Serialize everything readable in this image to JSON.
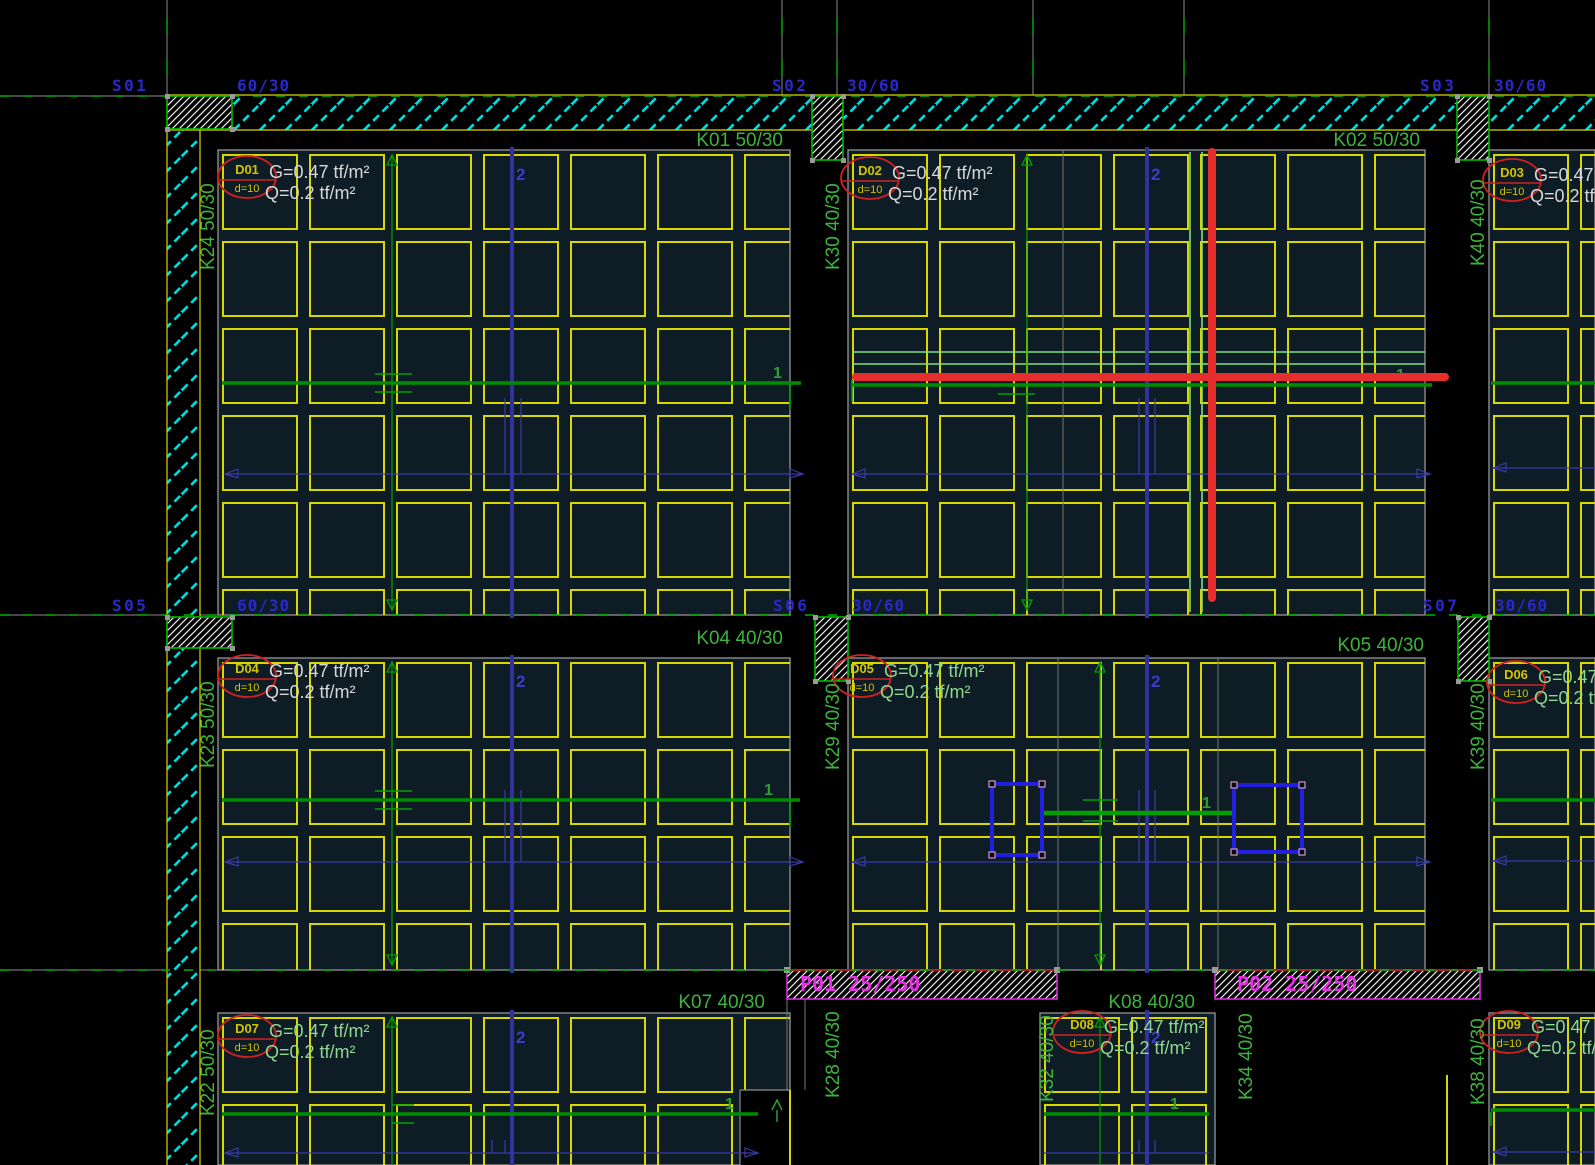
{
  "app": {
    "view_name": "slab-formwork-plan"
  },
  "colors": {
    "background": "#000000",
    "panel_fill": "#0e1c26",
    "rib": "#d8d800",
    "panel_border": "#8c8c8c",
    "wall_hatch": "#00dcdc",
    "column_hatch": "#ececec",
    "column_border": "#00bb00",
    "beam_label": "#3cb43c",
    "load_text_white": "#d8d8d8",
    "load_text_green": "#8fd88f",
    "column_label": "#2828cc",
    "strip_blue": "#32329c",
    "strip_blue_label": "#3c3cc8",
    "dim_blue": "#3a3aaa",
    "span_green": "#00a000",
    "strip_green": "#008c00",
    "strip_green_label": "#2da02d",
    "axis_green": "#00b400",
    "axis_gray": "#8a8a8a",
    "selection_red": "#e62e2e",
    "tag_red": "#d02020",
    "tag_yellow": "#d2c400",
    "magenta": "#e830e8",
    "rib_highlight": "#80e080",
    "grip": "#d098d0",
    "opening_blue": "#2020dd"
  },
  "axes": {
    "vertical_x": [
      167,
      782,
      837,
      1033,
      1184,
      1489
    ],
    "horizontal_y": [
      96,
      615,
      970
    ]
  },
  "walls": {
    "top": [
      167,
      95,
      1428,
      35
    ],
    "left": [
      167,
      130,
      33,
      1035
    ]
  },
  "shear_walls": [
    {
      "label": "P01 25/250",
      "rect": [
        787,
        970,
        270,
        29
      ],
      "label_pos": [
        800,
        991
      ]
    },
    {
      "label": "P02 25/250",
      "rect": [
        1215,
        970,
        265,
        29
      ],
      "label_pos": [
        1237,
        991
      ]
    }
  ],
  "columns": [
    {
      "name": "S01",
      "size": "60/30",
      "rect": [
        167,
        96,
        65,
        33
      ],
      "name_pos": [
        112,
        91
      ],
      "size_pos": [
        237,
        91
      ]
    },
    {
      "name": "S02",
      "size": "30/60",
      "rect": [
        812,
        96,
        31,
        64
      ],
      "name_pos": [
        772,
        91
      ],
      "size_pos": [
        847,
        91
      ]
    },
    {
      "name": "S03",
      "size": "30/60",
      "rect": [
        1457,
        96,
        32,
        64
      ],
      "name_pos": [
        1420,
        91
      ],
      "size_pos": [
        1494,
        91
      ]
    },
    {
      "name": "S05",
      "size": "60/30",
      "rect": [
        167,
        617,
        65,
        31
      ],
      "name_pos": [
        112,
        611
      ],
      "size_pos": [
        237,
        611
      ]
    },
    {
      "name": "S06",
      "size": "30/60",
      "rect": [
        815,
        617,
        33,
        64
      ],
      "name_pos": [
        773,
        611
      ],
      "size_pos": [
        852,
        611
      ]
    },
    {
      "name": "S07",
      "size": "30/60",
      "rect": [
        1458,
        617,
        31,
        64
      ],
      "name_pos": [
        1423,
        611
      ],
      "size_pos": [
        1495,
        611
      ]
    }
  ],
  "beams_horizontal": [
    {
      "label": "K01 50/30",
      "pos": [
        783,
        146
      ]
    },
    {
      "label": "K02 50/30",
      "pos": [
        1420,
        146
      ]
    },
    {
      "label": "K04 40/30",
      "pos": [
        783,
        644
      ]
    },
    {
      "label": "K05 40/30",
      "pos": [
        1424,
        651
      ]
    },
    {
      "label": "K07 40/30",
      "pos": [
        765,
        1008
      ]
    },
    {
      "label": "K08 40/30",
      "pos": [
        1195,
        1008
      ]
    }
  ],
  "beams_vertical": [
    {
      "label": "K24 50/30",
      "pos": [
        214,
        270
      ]
    },
    {
      "label": "K30 40/30",
      "pos": [
        839,
        270
      ]
    },
    {
      "label": "K40 40/30",
      "pos": [
        1484,
        266
      ]
    },
    {
      "label": "K23 50/30",
      "pos": [
        214,
        768
      ]
    },
    {
      "label": "K29 40/30",
      "pos": [
        839,
        770
      ]
    },
    {
      "label": "K39 40/30",
      "pos": [
        1484,
        770
      ]
    },
    {
      "label": "K22 50/30",
      "pos": [
        214,
        1116
      ]
    },
    {
      "label": "K28 40/30",
      "pos": [
        839,
        1098
      ]
    },
    {
      "label": "K32 40/30",
      "pos": [
        1053,
        1102
      ]
    },
    {
      "label": "K34 40/30",
      "pos": [
        1252,
        1100
      ]
    },
    {
      "label": "K38 40/30",
      "pos": [
        1484,
        1105
      ]
    }
  ],
  "panels": [
    {
      "id": "P1",
      "slab": "D01",
      "rect": [
        218,
        150,
        572,
        465
      ]
    },
    {
      "id": "P2",
      "slab": "D02",
      "rect": [
        848,
        150,
        577,
        465
      ]
    },
    {
      "id": "P3",
      "slab": "D03",
      "rect": [
        1489,
        150,
        106,
        465
      ]
    },
    {
      "id": "P4",
      "slab": "D04",
      "rect": [
        218,
        658,
        572,
        312
      ]
    },
    {
      "id": "P5",
      "slab": "D05",
      "rect": [
        848,
        658,
        577,
        312
      ]
    },
    {
      "id": "P6",
      "slab": "D06",
      "rect": [
        1489,
        658,
        106,
        312
      ]
    },
    {
      "id": "P7",
      "slab": "D07",
      "rect": [
        218,
        1013,
        572,
        152
      ]
    },
    {
      "id": "P8",
      "slab": "D08",
      "rect": [
        1040,
        1013,
        175,
        152
      ]
    },
    {
      "id": "P9",
      "slab": "D09",
      "rect": [
        1489,
        1013,
        106,
        152
      ]
    }
  ],
  "slab_tags": [
    {
      "id": "D01",
      "thickness": "d=10",
      "g": "G=0.47 tf/m²",
      "q": "Q=0.2 tf/m²",
      "pos": [
        247,
        177
      ],
      "green": false
    },
    {
      "id": "D02",
      "thickness": "d=10",
      "g": "G=0.47 tf/m²",
      "q": "Q=0.2 tf/m²",
      "pos": [
        870,
        178
      ],
      "green": false
    },
    {
      "id": "D03",
      "thickness": "d=10",
      "g": "G=0.47 tf/m²",
      "q": "Q=0.2 tf/m²",
      "pos": [
        1512,
        180
      ],
      "green": false
    },
    {
      "id": "D04",
      "thickness": "d=10",
      "g": "G=0.47 tf/m²",
      "q": "Q=0.2 tf/m²",
      "pos": [
        247,
        676
      ],
      "green": false
    },
    {
      "id": "D05",
      "thickness": "d=10",
      "g": "G=0.47 tf/m²",
      "q": "Q=0.2 tf/m²",
      "pos": [
        862,
        676
      ],
      "green": true
    },
    {
      "id": "D06",
      "thickness": "d=10",
      "g": "G=0.47 tf/m²",
      "q": "Q=0.2 tf/m²",
      "pos": [
        1516,
        682
      ],
      "green": true
    },
    {
      "id": "D07",
      "thickness": "d=10",
      "g": "G=0.47 tf/m²",
      "q": "Q=0.2 tf/m²",
      "pos": [
        247,
        1036
      ],
      "green": true
    },
    {
      "id": "D08",
      "thickness": "d=10",
      "g": "G=0.47 tf/m²",
      "q": "Q=0.2 tf/m²",
      "pos": [
        1082,
        1032
      ],
      "green": true
    },
    {
      "id": "D09",
      "thickness": "d=10",
      "g": "G=0.47 tf/m²",
      "q": "Q=0.2 tf/m²",
      "pos": [
        1509,
        1032
      ],
      "green": true
    }
  ],
  "span_arrows": [
    {
      "x": 392,
      "y1": 155,
      "y2": 610,
      "up": true,
      "down": true
    },
    {
      "x": 1027,
      "y1": 155,
      "y2": 610,
      "up": true,
      "down": true
    },
    {
      "x": 392,
      "y1": 662,
      "y2": 965,
      "up": true,
      "down": true
    },
    {
      "x": 1100,
      "y1": 662,
      "y2": 965,
      "up": true,
      "down": true
    },
    {
      "x": 392,
      "y1": 1017,
      "y2": 1165,
      "up": true,
      "down": false
    },
    {
      "x": 1100,
      "y1": 1017,
      "y2": 1165,
      "up": true,
      "down": false
    }
  ],
  "strip2_lines": [
    {
      "x": 512,
      "y1": 147,
      "y2": 618,
      "label": "2",
      "label_pos": [
        516,
        180
      ]
    },
    {
      "x": 1147,
      "y1": 147,
      "y2": 618,
      "label": "2",
      "label_pos": [
        1151,
        180
      ]
    },
    {
      "x": 512,
      "y1": 655,
      "y2": 973,
      "label": "2",
      "label_pos": [
        516,
        687
      ]
    },
    {
      "x": 1147,
      "y1": 655,
      "y2": 973,
      "label": "2",
      "label_pos": [
        1151,
        687
      ]
    },
    {
      "x": 512,
      "y1": 1010,
      "y2": 1165,
      "label": "2",
      "label_pos": [
        516,
        1043
      ]
    },
    {
      "x": 1147,
      "y1": 1010,
      "y2": 1165,
      "label": "2",
      "label_pos": [
        1151,
        1043
      ]
    }
  ],
  "strip1_lines": [
    {
      "x1": 222,
      "x2": 801,
      "y": 383,
      "label": "1",
      "label_pos": [
        773,
        378
      ],
      "ticks_x": [
        375,
        412
      ],
      "tick_ys": [
        374,
        392
      ],
      "end_tick": [
        790,
        386,
        410
      ]
    },
    {
      "x1": 852,
      "x2": 1432,
      "y": 385,
      "label": "1",
      "label_pos": [
        1396,
        380
      ],
      "ticks_x": [
        998,
        1035
      ],
      "tick_ys": [
        376,
        394
      ],
      "end_tick": [
        852,
        380,
        402
      ]
    },
    {
      "x1": 1491,
      "x2": 1595,
      "y": 383
    },
    {
      "x1": 222,
      "x2": 800,
      "y": 800,
      "label": "1",
      "label_pos": [
        764,
        795
      ],
      "ticks_x": [
        375,
        412
      ],
      "tick_ys": [
        791,
        809
      ],
      "end_tick": [
        790,
        802,
        827
      ]
    },
    {
      "x1": 1491,
      "x2": 1595,
      "y": 800
    },
    {
      "x1": 222,
      "x2": 758,
      "y": 1114,
      "label": "1",
      "label_pos": [
        725,
        1109
      ],
      "ticks_x": [
        392,
        414
      ],
      "tick_ys": [
        1105,
        1123
      ]
    },
    {
      "x1": 1044,
      "x2": 1209,
      "y": 1114,
      "label": "1",
      "label_pos": [
        1170,
        1109
      ]
    },
    {
      "x1": 1491,
      "x2": 1595,
      "y": 1110,
      "end_tick": [
        1491,
        1112,
        1126
      ]
    }
  ],
  "opening_link": {
    "y": 813,
    "x1": 1042,
    "x2": 1234,
    "label": "1",
    "label_pos": [
      1202,
      808
    ],
    "tick_h_x": [
      1083,
      1118
    ],
    "tick_h_ys": [
      800,
      821
    ],
    "tick_v": [
      1100,
      793,
      827
    ]
  },
  "openings": [
    {
      "rect": [
        992,
        784,
        50,
        71
      ]
    },
    {
      "rect": [
        1234,
        785,
        68,
        67
      ]
    }
  ],
  "dim_lines": [
    {
      "x1": 225,
      "x2": 803,
      "y": 474,
      "la": true,
      "ra": true,
      "ticks": [
        [
          505,
          398
        ],
        [
          521,
          398
        ]
      ]
    },
    {
      "x1": 852,
      "x2": 1430,
      "y": 474,
      "la": true,
      "ra": true,
      "ticks": [
        [
          1139,
          398
        ],
        [
          1155,
          398
        ]
      ]
    },
    {
      "x1": 1493,
      "x2": 1595,
      "y": 468,
      "la": true,
      "ra": false,
      "ticks": []
    },
    {
      "x1": 225,
      "x2": 803,
      "y": 862,
      "la": true,
      "ra": true,
      "ticks": [
        [
          505,
          790
        ],
        [
          521,
          790
        ]
      ]
    },
    {
      "x1": 852,
      "x2": 1430,
      "y": 862,
      "la": true,
      "ra": true,
      "ticks": [
        [
          1139,
          790
        ],
        [
          1155,
          790
        ]
      ]
    },
    {
      "x1": 1493,
      "x2": 1595,
      "y": 861,
      "la": true,
      "ra": false,
      "ticks": []
    },
    {
      "x1": 225,
      "x2": 758,
      "y": 1153,
      "la": true,
      "ra": true,
      "ticks": [
        [
          492,
          1140
        ],
        [
          505,
          1140
        ]
      ]
    },
    {
      "x1": 1044,
      "x2": 1209,
      "y": 1153,
      "la": false,
      "ra": false,
      "ticks": [
        [
          1139,
          1140
        ],
        [
          1155,
          1140
        ]
      ]
    },
    {
      "x1": 1493,
      "x2": 1595,
      "y": 1152,
      "la": true,
      "ra": false,
      "ticks": []
    }
  ],
  "selection_red": {
    "h": {
      "x1": 856,
      "x2": 1445,
      "y": 377
    },
    "v": {
      "x": 1212,
      "y1": 152,
      "y2": 598
    }
  },
  "rib_highlights": {
    "h_ys": [
      352,
      364
    ],
    "h_x": [
      852,
      1425
    ],
    "v_xs": [
      1190,
      1202
    ],
    "v_y": [
      152,
      612
    ]
  },
  "inner_gray_lines": [
    {
      "x": 1063,
      "y1": 150,
      "y2": 615
    },
    {
      "x": 1058,
      "y1": 658,
      "y2": 970
    },
    {
      "x": 1218,
      "y1": 658,
      "y2": 970
    },
    {
      "x": 787,
      "y1": 970,
      "y2": 1090
    },
    {
      "x": 805,
      "y1": 970,
      "y2": 1090
    }
  ],
  "notch": {
    "rect": [
      740,
      1090,
      50,
      75
    ],
    "arrow_x": 777,
    "arrow_y": 1100,
    "yellow_stub1": [
      790,
      1090,
      1165
    ],
    "yellow_stub2": [
      1447,
      1075,
      1165
    ]
  },
  "rib_grid": {
    "pitch": 87,
    "size": 74,
    "inset": 5
  }
}
